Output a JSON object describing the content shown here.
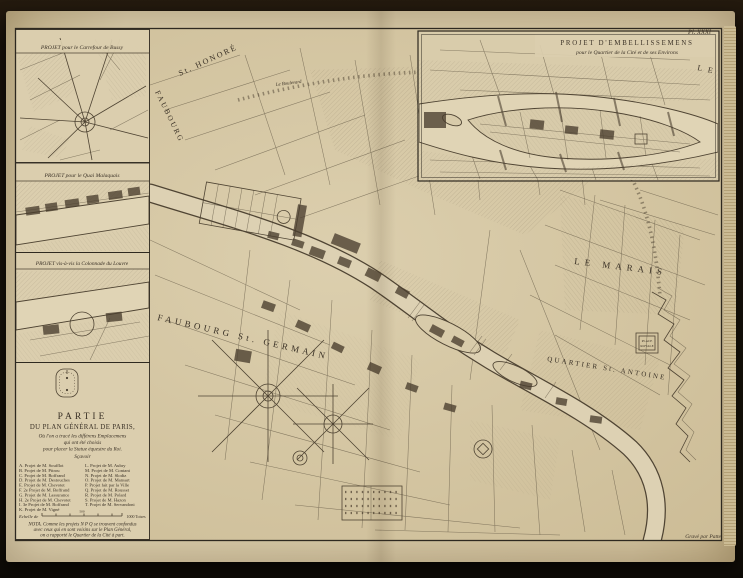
{
  "plate": {
    "number": "Pl. XXXI",
    "credit": "Gravé par Patte"
  },
  "insets": {
    "bussy": {
      "title": "PROJET pour le Carrefour de Bussy"
    },
    "malaquais": {
      "title": "PROJET pour le Quai Malaquais"
    },
    "colonnade": {
      "title": "PROJET vis-à-vis la Colonnade du Louvre"
    },
    "cite": {
      "title1": "PROJET D'EMBELLISSEMENS",
      "title2": "pour le Quartier de la Cité et de ses Environs",
      "corner_label": "L E"
    }
  },
  "cartouche": {
    "title1": "PARTIE",
    "title2": "DU PLAN GÉNÉRAL DE PARIS,",
    "sub1": "Où l'on a tracé les différens Emplacemens",
    "sub2": "qui ont été choisis",
    "sub3": "pour placer la Statue équestre du Roi.",
    "savoir": "Sçavoir",
    "legend_left": [
      "A. Projet de M. Soufflot",
      "B. Projet de M. Pitrou",
      "C. Projet de M. Boffrand",
      "D. Projet de M. Destouches",
      "E. Projet de M. Chevotet",
      "F. 2e Projet de M. Boffrand",
      "G. Projet de M. Lassurance",
      "H. 2e Projet de M. Chevotet",
      "I. 3e Projet de M. Boffrand",
      "K. Projet de M. Vigné"
    ],
    "legend_right": [
      "L. Projet de M. Aubry",
      "M. Projet de M. Contant",
      "N. Projet de M. Slodtz",
      "O. Projet de M. Mansart",
      "P. Projet fait par la Ville",
      "Q. Projet de M. Rousset",
      "R. Projet de M. Polard",
      "S. Projet de M. Hazon",
      "T. Projet de M. Servandoni"
    ],
    "scale_left": "Echelle de",
    "scale_mid": "500",
    "scale_right": "1000 Toises",
    "nota1": "NOTA. Comme les projets N P Q se trouvent confondus",
    "nota2": "avec ceux qui en sont voisins sur le Plan Général,",
    "nota3": "on a rapporté le Quartier de la Cité à part."
  },
  "map_labels": {
    "faubourg": "FAUBOURG",
    "st_honore": "St. HONORÉ",
    "boulevard": "Le Boulevard",
    "faubourg_st_germain": "FAUBOURG  St.  GERMAIN",
    "le_marais": "LE  MARAIS",
    "quartier_st_antoine": "QUARTIER  St.  ANTOINE",
    "place_royale_1": "PLACE",
    "place_royale_2": "ROYALE"
  },
  "colors": {
    "paper": "#d8caa8",
    "ink": "#4a4032",
    "water": "#e0d4b5",
    "photo_background": "#17100a"
  }
}
